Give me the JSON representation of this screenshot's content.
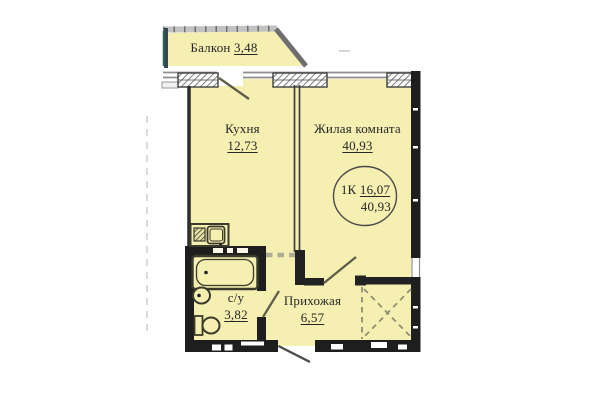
{
  "rooms": [
    {
      "key": "balcony",
      "label": "Балкон",
      "area": "3,48"
    },
    {
      "key": "kitchen",
      "label": "Кухня",
      "area": "12,73"
    },
    {
      "key": "living",
      "label": "Жилая комната",
      "area": "40,93"
    },
    {
      "key": "bathroom",
      "label": "с/у",
      "area": "3,82"
    },
    {
      "key": "hallway",
      "label": "Прихожая",
      "area": "6,57"
    }
  ],
  "stamp": {
    "type": "1К",
    "living_area": "16,07",
    "total_area": "40,93"
  },
  "colors": {
    "floor": "#F5EFB2",
    "wall": "#1E1E1E",
    "thin_wall": "#3D3D3D",
    "window_hatch": "#7F7F7F",
    "balcony_parapet": "#C2C2C2",
    "balcony_accent": "#2F6B52",
    "door_line": "#5E5E49",
    "closet_dash": "#8E8E74",
    "guide_dash": "#CDD3D6",
    "stamp_outline": "#4A4A4A"
  }
}
